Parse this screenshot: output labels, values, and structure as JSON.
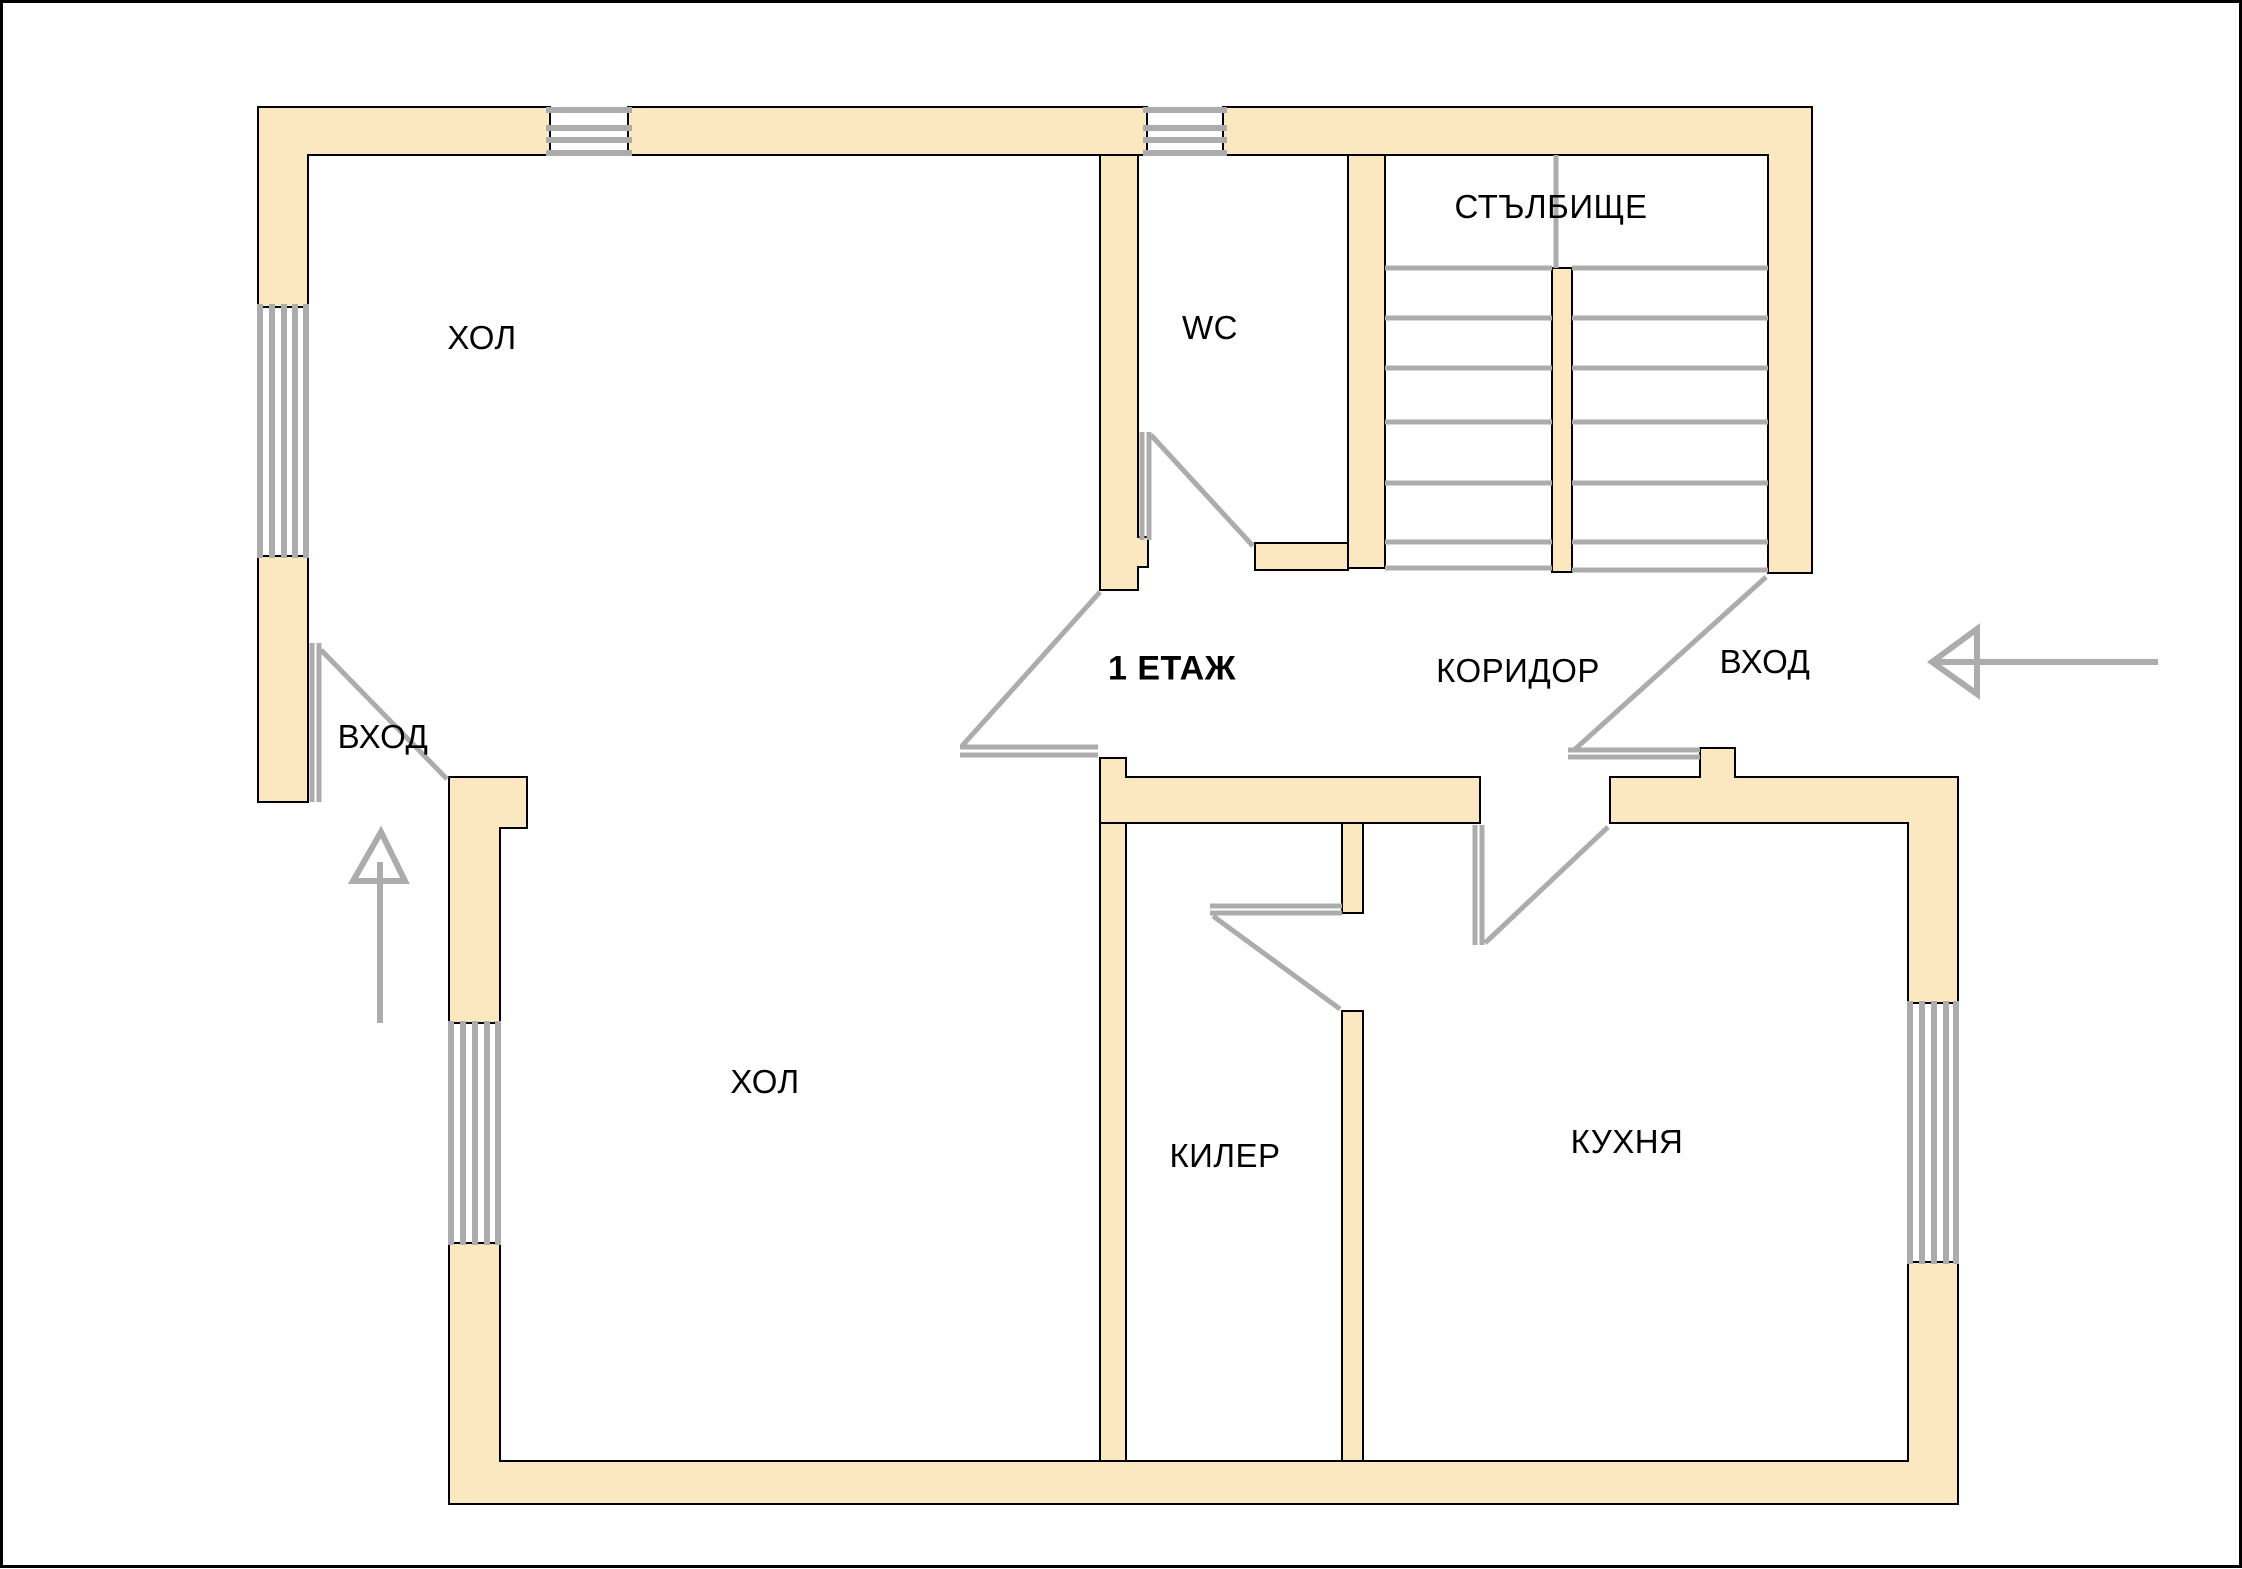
{
  "plan": {
    "floor_label": "1 ЕТАЖ",
    "room_labels": {
      "hall_upper": "ХОЛ",
      "wc": "WC",
      "staircase": "СТЪЛБИЩЕ",
      "corridor": "КОРИДОР",
      "entrance_left": "ВХОД",
      "entrance_right": "ВХОД",
      "hall_lower": "ХОЛ",
      "pantry": "КИЛЕР",
      "kitchen": "КУХНЯ"
    },
    "colors": {
      "wall_fill": "#fce8c0",
      "wall_outline": "#000000",
      "detail_gray": "#acacac",
      "background": "#ffffff",
      "label_text": "#000000"
    }
  }
}
